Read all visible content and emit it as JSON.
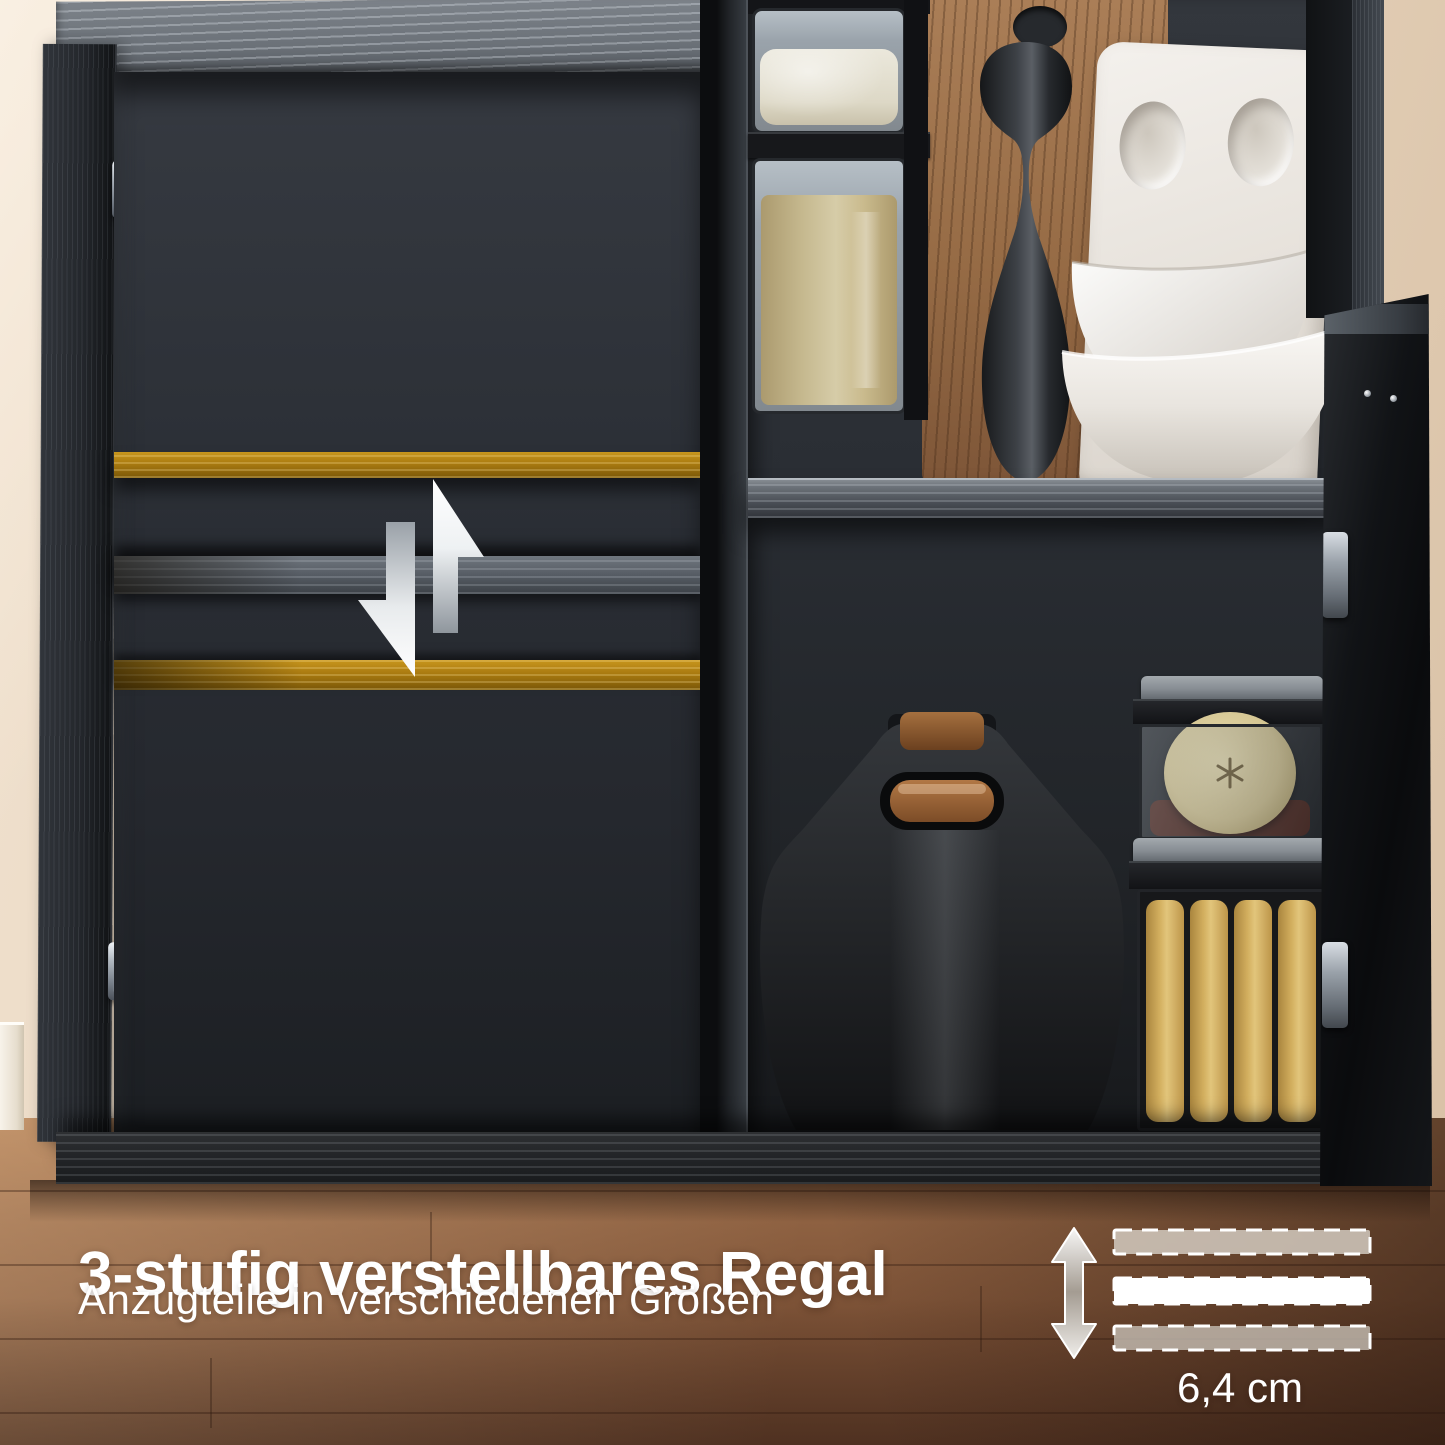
{
  "overlay": {
    "headline": "3-stufig verstellbares Regal",
    "subline": "Anzugteile in verschiedenen Größen"
  },
  "measurement": {
    "label": "6,4 cm",
    "shelf_positions": 3
  },
  "icons": {
    "shelf_adjust": "swap-vertical-arrows-icon",
    "height_range": "double-vertical-arrow-icon",
    "shelf_slots": "dashed-bar"
  },
  "colors": {
    "wall": "#e9d7c2",
    "floor_wood": "#8a5e3f",
    "cabinet_black": "#1e2125",
    "shelf_gold": "#a97a10",
    "text": "#ffffff"
  }
}
